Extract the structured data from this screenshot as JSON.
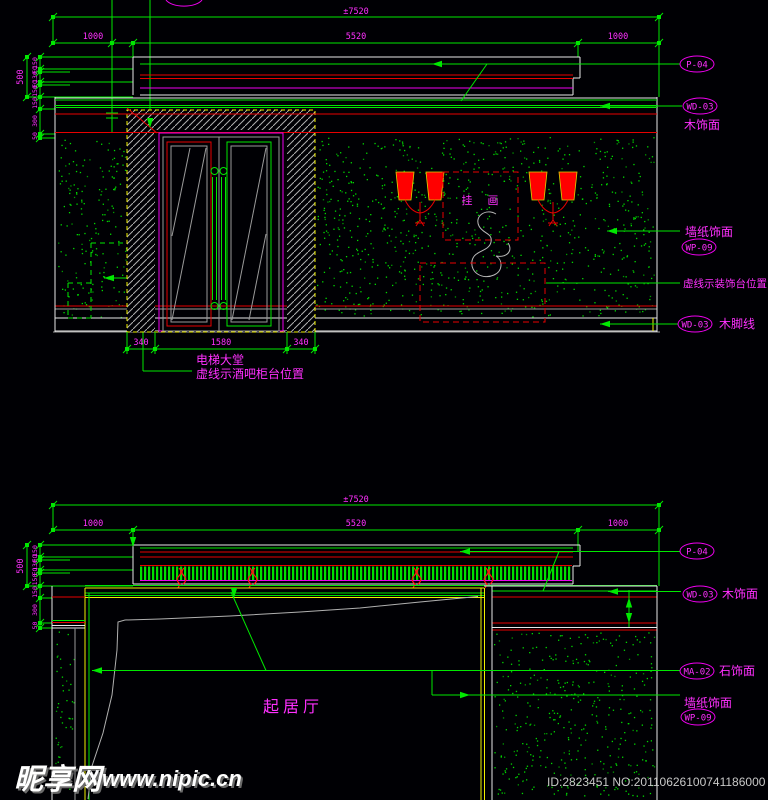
{
  "palette": {
    "background": "#000004",
    "cad_green": "#00e800",
    "cad_magenta": "#ff30ff",
    "cad_red": "#e80000",
    "cad_yellow": "#f0f000",
    "cad_white": "#e8e8e8",
    "cad_gray": "#9a9a9a",
    "lamp_red": "#ff0000"
  },
  "watermark": {
    "site": "昵享网",
    "url": "www.nipic.cn",
    "id_no": "ID:2823451 NO:20110626100741186000"
  },
  "top": {
    "room": "电梯大堂",
    "bar_note": "虚线示酒吧柜台位置",
    "art": "挂 画",
    "console_note": "虚线示装饰台位置",
    "dim_total": "±7520",
    "w": [
      "1000",
      "5520",
      "1000"
    ],
    "h_total": "500",
    "chain": [
      "150",
      "EQ",
      "130",
      "EQ",
      "150"
    ],
    "chain2": [
      "150",
      "300",
      "50"
    ],
    "door": [
      "340",
      "1580",
      "340"
    ],
    "p04": "P-04",
    "wd03": "WD-03",
    "wd03_t": "木饰面",
    "wp09": "WP-09",
    "wp09_t": "墙纸饰面",
    "wd03b": "WD-03",
    "wd03b_t": "木脚线"
  },
  "bottom": {
    "room": "起居厅",
    "dim_total": "±7520",
    "w": [
      "1000",
      "5520",
      "1000"
    ],
    "h_total": "500",
    "chain": [
      "150",
      "EQ",
      "130",
      "EQ",
      "150"
    ],
    "chain2": [
      "150",
      "300",
      "50"
    ],
    "p04": "P-04",
    "wd03": "WD-03",
    "wd03_t": "木饰面",
    "ma02": "MA-02",
    "ma02_t": "石饰面",
    "wp09": "WP-09",
    "wp09_t": "墙纸饰面"
  }
}
